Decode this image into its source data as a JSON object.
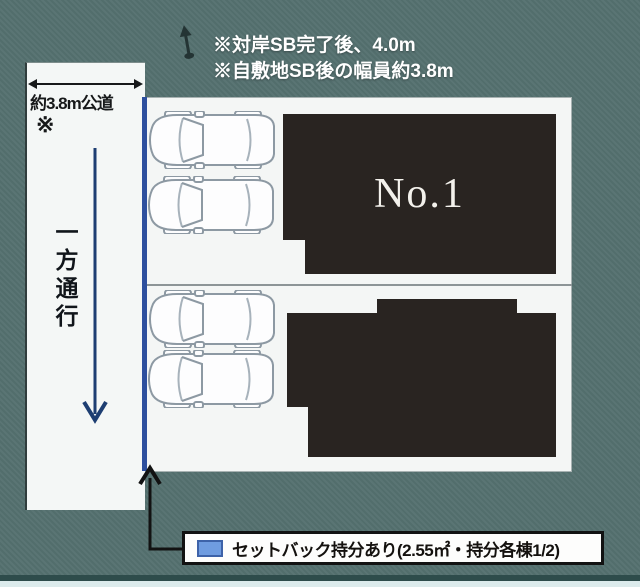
{
  "colors": {
    "background": "#557170",
    "paper": "#f4f6f5",
    "building": "#292421",
    "setback_line": "#2d4f9e",
    "one_way_arrow": "#1d3e72",
    "legend_swatch": "#6f9ce0",
    "note_text": "#ffffff"
  },
  "header": {
    "note1": "※対岸SB完了後、4.0m",
    "note2": "※自敷地SB後の幅員約3.8m"
  },
  "road": {
    "width_label": "約3.8m公道",
    "note_mark": "※",
    "one_way_label": "一方通行"
  },
  "site": {
    "buildings": [
      {
        "label": "No.1"
      },
      {
        "label": ""
      }
    ],
    "parking_spaces": 4
  },
  "legend": {
    "label": "セットバック持分あり(2.55㎡・持分各棟1/2)"
  }
}
